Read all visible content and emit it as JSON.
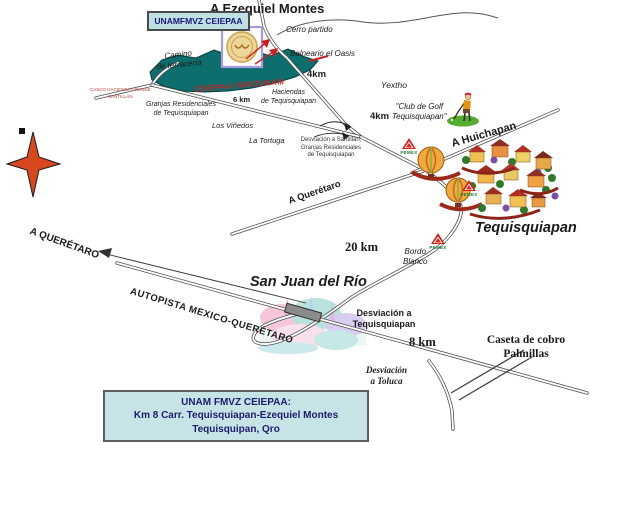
{
  "map": {
    "facility_box": "UNAMFMVZ CEIEPAA",
    "pemex_label": "PEMEX",
    "directions": {
      "a_ezequiel_montes": "A Ezequiel Montes",
      "a_huichapan": "A Huichapan",
      "a_queretaro_road": "A Querétaro",
      "a_queretaro_highway": "A QUERÉTARO",
      "autopista": "AUTOPISTA MEXICO-QUERÉTARO"
    },
    "towns": {
      "tequisquiapan": "Tequisquiapan",
      "san_juan_del_rio": "San Juan del Río"
    },
    "distances": {
      "km4_balneario": "4km",
      "km6": "6 km",
      "km4_golf": "4km",
      "km20": "20 km",
      "km8": "8 km"
    },
    "landmarks": {
      "cerro_partido": "Cerro partido",
      "balneario_oasis": "Balneario el Oasis",
      "camino_terraceria": "Camino\nde terracería",
      "ceiepaa_road_label": "CEIEPAA FMVZUNAM",
      "casco_hacienda": "CASCO HACIENDA GRANDE\nSANTILLÁN",
      "granjas_residenciales": "Granjas Residenciales\nde Tequisquiapan",
      "los_vinedos": "Los Viñedos",
      "la_tortuga": "La Tortuga",
      "haciendas": "Haciendas\nde Tequisquiapan",
      "yextho": "Yextho",
      "club_de_golf": "\"Club de Golf\nTequisquiapan\"",
      "desviacion_santillan": "Desviación a Santillán,\nGranjas Residenciales\nde Tequisquiapan",
      "bordo_blanco": "Bordo\nBlanco",
      "desviacion_tequisquiapan": "Desviación a\nTequisquiapan",
      "caseta_cobro": "Caseta de cobro\nPalmillas",
      "desviacion_toluca": "Desviación\na Toluca"
    },
    "info_box": {
      "line1": "UNAM FMVZ CEIEPAA:",
      "line2": "Km 8 Carr. Tequisquiapan-Ezequiel Montes",
      "line3": "Tequisquipan, Qro"
    },
    "colors": {
      "land_teal": "#0d6e6d",
      "panel_bg": "#c6e3e5",
      "accent_red": "#cc2020",
      "compass_orange": "#d8481f",
      "pemex_red": "#d8231f",
      "pemex_green": "#1c7a34"
    }
  }
}
